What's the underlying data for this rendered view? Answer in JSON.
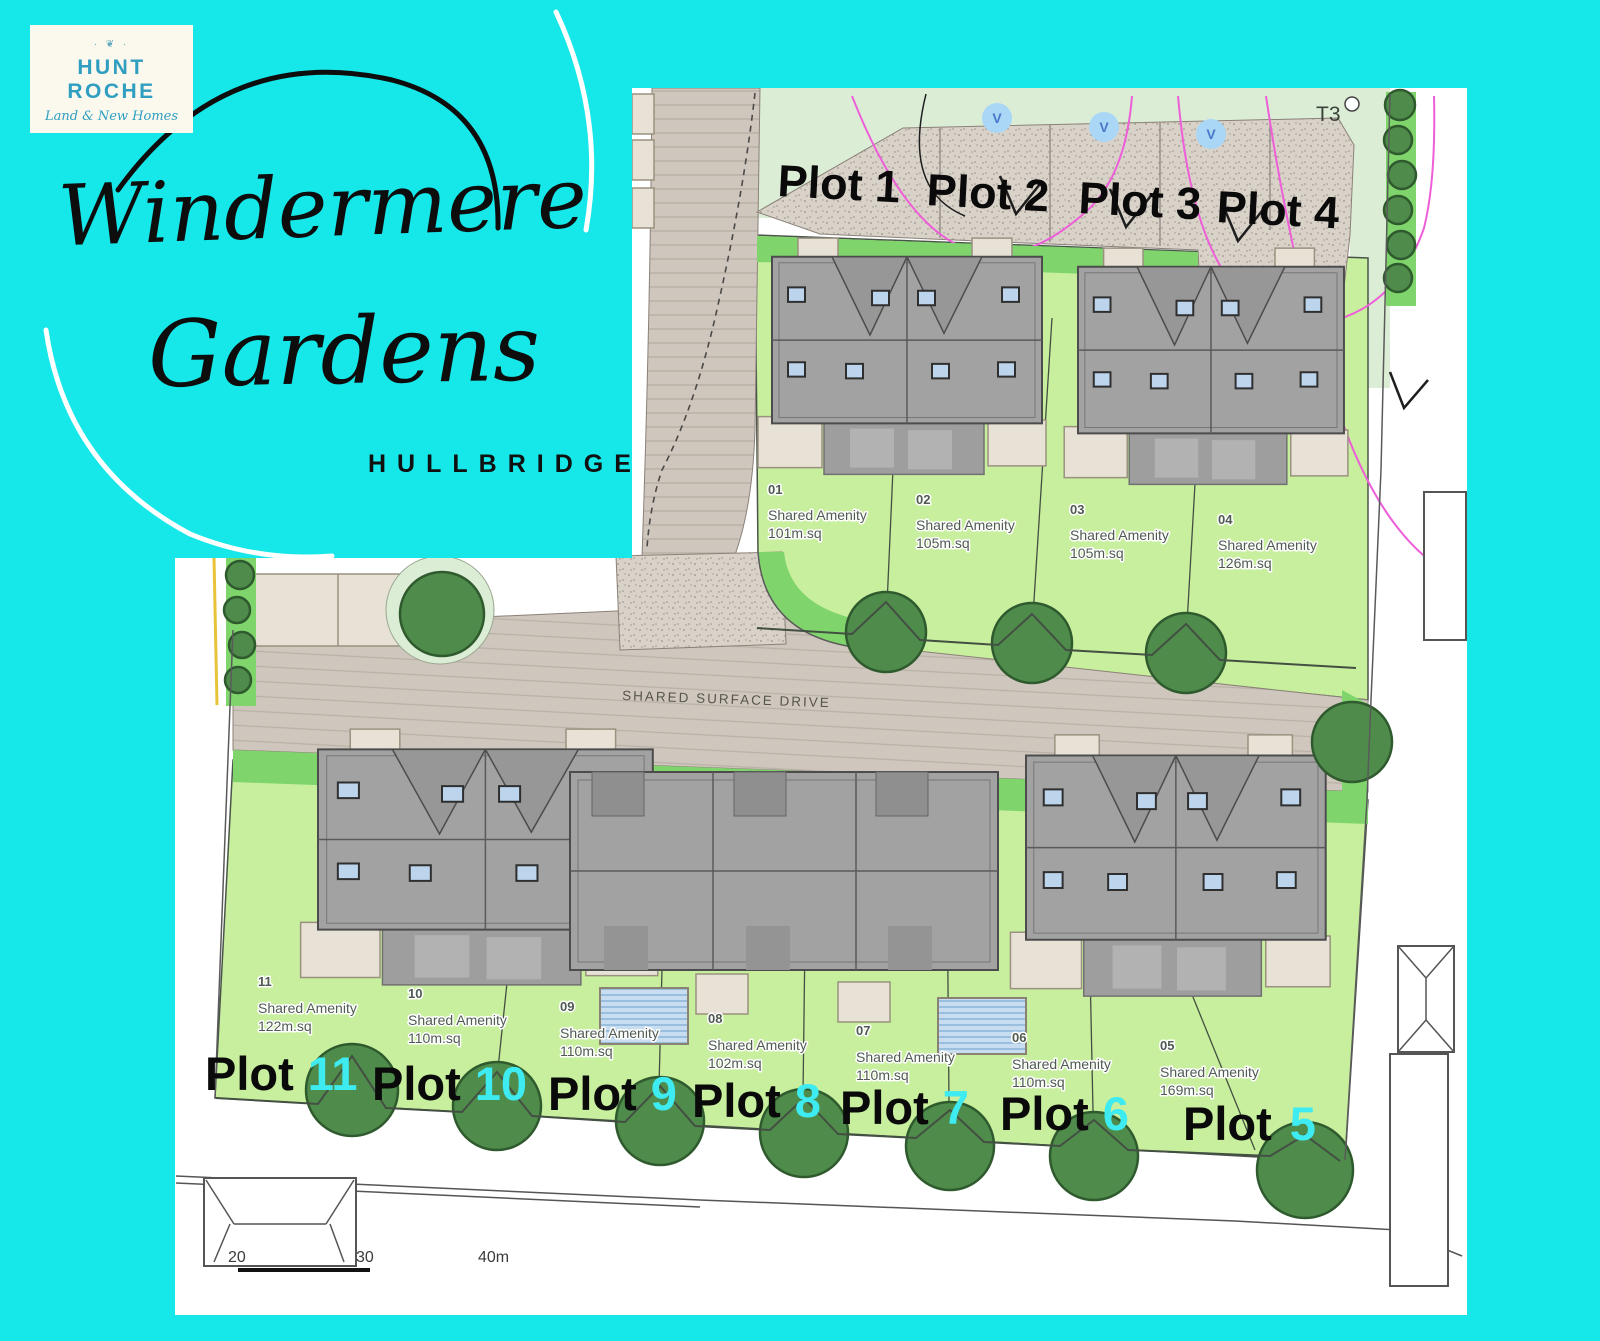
{
  "branding": {
    "logo_name": "HUNT ROCHE",
    "logo_tagline": "Land & New Homes",
    "logo_ornament": "· ❦ ·",
    "title_line1": "Windermere",
    "title_line2": "Gardens",
    "subtitle": "HULLBRIDGE"
  },
  "plan": {
    "road_label": "SHARED SURFACE DRIVE",
    "tree_tag": "T3",
    "visitor_marker": "V",
    "amenity_label": "Shared Amenity",
    "scale": {
      "m20": "20",
      "m30": "30",
      "m40": "40m"
    },
    "top_plots": [
      {
        "title": "Plot 1",
        "num": "01",
        "area": "101m.sq"
      },
      {
        "title": "Plot 2",
        "num": "02",
        "area": "105m.sq"
      },
      {
        "title": "Plot 3",
        "num": "03",
        "area": "105m.sq"
      },
      {
        "title": "Plot 4",
        "num": "04",
        "area": "126m.sq"
      }
    ],
    "bottom_plots": [
      {
        "word": "Plot",
        "num": "11",
        "id": "11",
        "area": "122m.sq"
      },
      {
        "word": "Plot",
        "num": "10",
        "id": "10",
        "area": "110m.sq"
      },
      {
        "word": "Plot",
        "num": "9",
        "id": "09",
        "area": "110m.sq"
      },
      {
        "word": "Plot",
        "num": "8",
        "id": "08",
        "area": "102m.sq"
      },
      {
        "word": "Plot",
        "num": "7",
        "id": "07",
        "area": "110m.sq"
      },
      {
        "word": "Plot",
        "num": "6",
        "id": "06",
        "area": "110m.sq"
      },
      {
        "word": "Plot",
        "num": "5",
        "id": "05",
        "area": "169m.sq"
      }
    ],
    "colors": {
      "background_cyan": "#16E7E9",
      "plot_number_cyan": "#3DEBF0",
      "garden_light": "#C8EF9D",
      "verge_green": "#7FD56C",
      "tree_green": "#4F8C4B",
      "roof_grey": "#A2A2A2",
      "drive_beige": "#CFC7BD",
      "magenta": "#EE5ED8",
      "brand_teal": "#2F9EC0"
    }
  }
}
